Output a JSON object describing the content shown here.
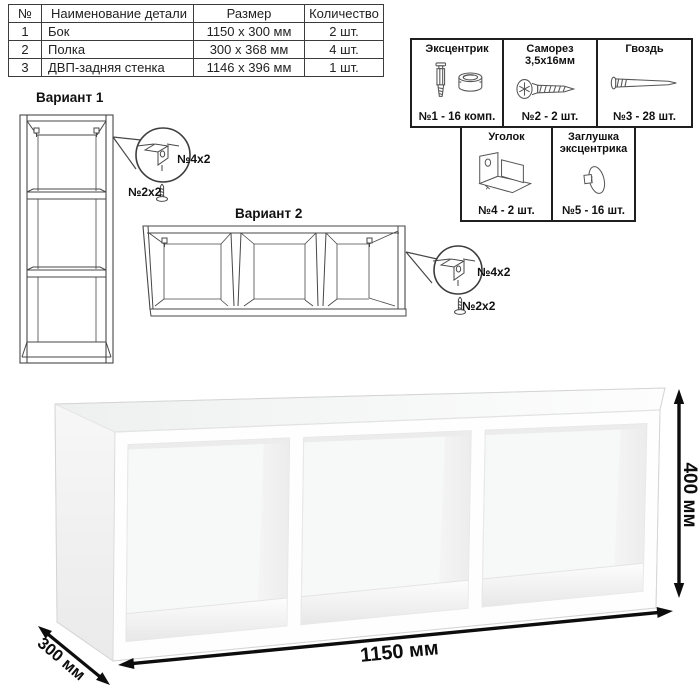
{
  "parts_table": {
    "headers": {
      "num": "№",
      "name": "Наименование детали",
      "size": "Размер",
      "qty": "Количество"
    },
    "rows": [
      {
        "num": "1",
        "name": "Бок",
        "size": "1150 x 300 мм",
        "qty": "2 шт."
      },
      {
        "num": "2",
        "name": "Полка",
        "size": "300 x 368 мм",
        "qty": "4 шт."
      },
      {
        "num": "3",
        "name": "ДВП-задняя стенка",
        "size": "1146 x 396 мм",
        "qty": "1 шт."
      }
    ]
  },
  "hardware_legend": {
    "eccentric": {
      "name": "Эксцентрик",
      "count": "№1 - 16 комп."
    },
    "screw": {
      "name": "Саморез 3,5х16мм",
      "count": "№2 - 2 шт."
    },
    "nail": {
      "name": "Гвоздь",
      "count": "№3 - 28 шт."
    },
    "bracket": {
      "name": "Уголок",
      "count": "№4 - 2 шт."
    },
    "cap": {
      "name": "Заглушка эксцентрика",
      "count": "№5 - 16 шт."
    }
  },
  "variants": {
    "variant1_label": "Вариант 1",
    "variant2_label": "Вариант 2",
    "callout1": {
      "bracket_qty": "№4х2",
      "screw_qty": "№2х2"
    },
    "callout2": {
      "bracket_qty": "№4х2",
      "screw_qty": "№2х2"
    }
  },
  "dimensions": {
    "width": "1150 мм",
    "height": "400 мм",
    "depth": "300 мм"
  },
  "colors": {
    "line": "#474747",
    "dim_arrow": "#0d0d0d",
    "shelf_back": "#f7f8f8",
    "shelf_shadow": "#e9e9e9"
  }
}
